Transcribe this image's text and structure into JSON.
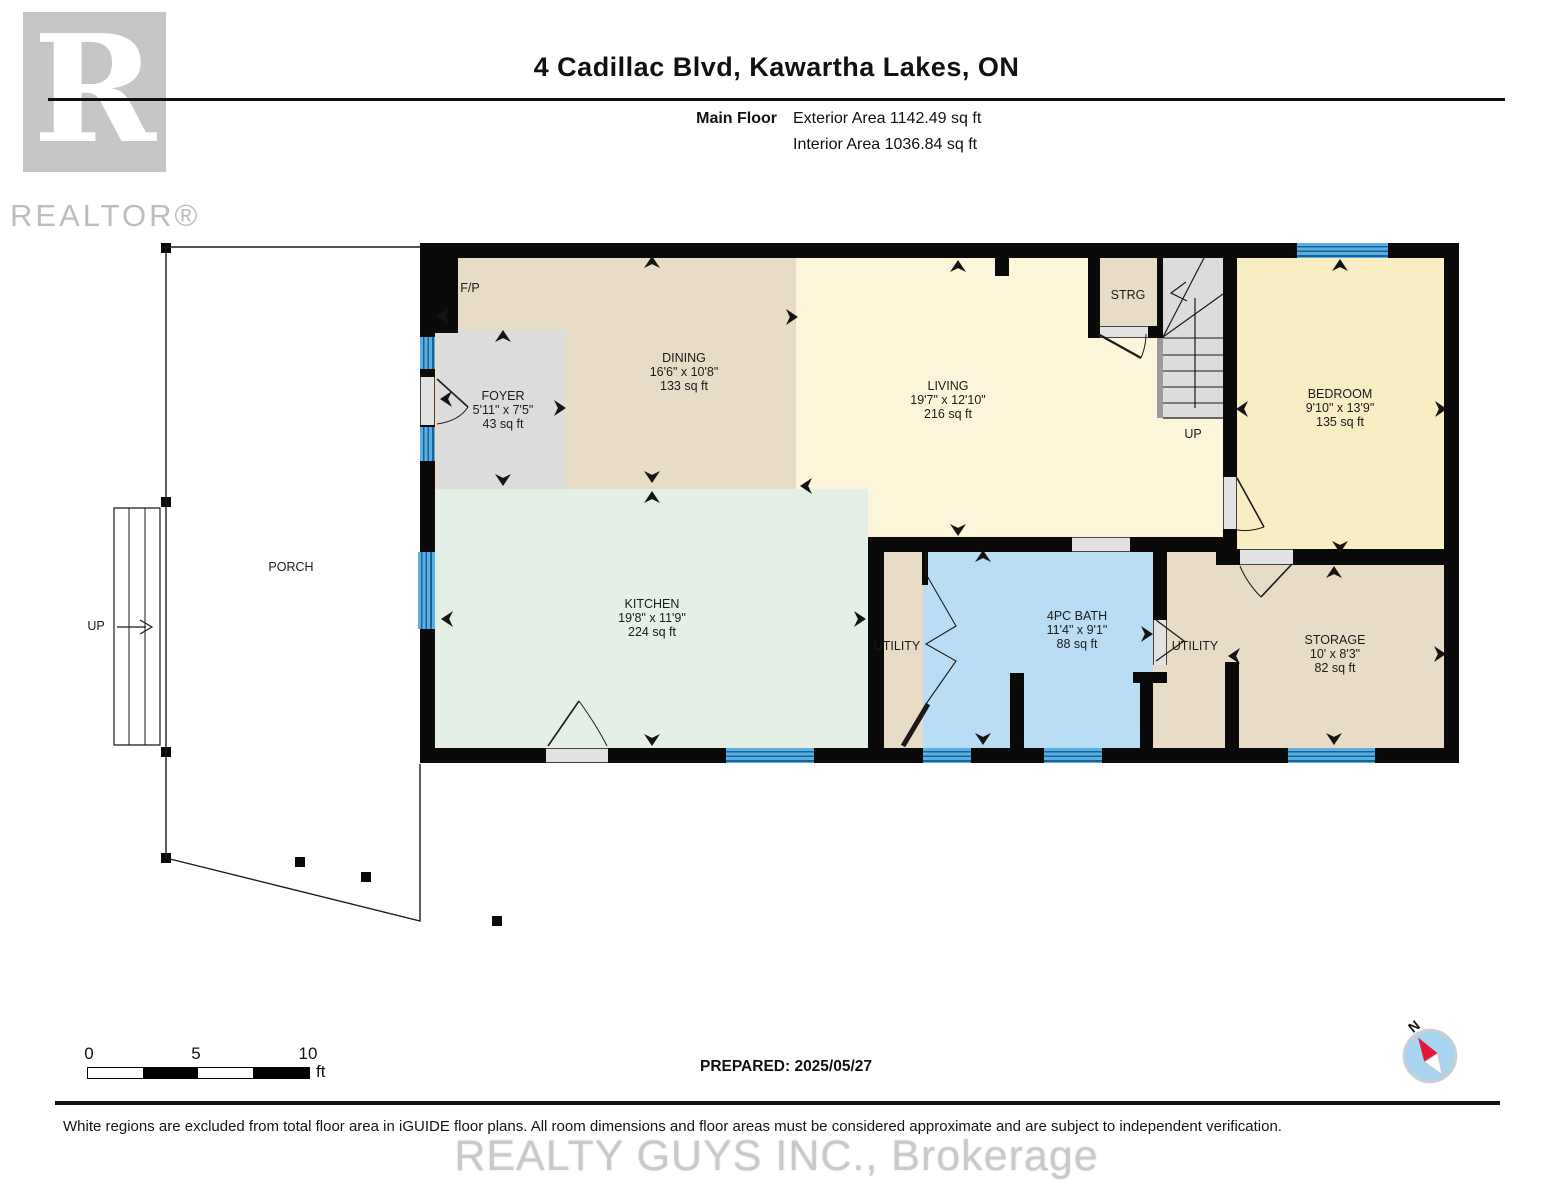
{
  "header": {
    "title": "4 Cadillac Blvd, Kawartha Lakes, ON",
    "floor_label": "Main Floor",
    "exterior_area": "Exterior Area 1142.49 sq ft",
    "interior_area": "Interior Area 1036.84 sq ft",
    "logo_letter": "R",
    "logo_text": "REALTOR®"
  },
  "footer": {
    "scale": {
      "ticks": [
        "0",
        "5",
        "10"
      ],
      "unit": "ft"
    },
    "prepared": "PREPARED: 2025/05/27",
    "disclaimer": "White regions are excluded from total floor area in iGUIDE floor plans. All room dimensions and floor areas must be considered approximate and are subject to independent verification.",
    "watermark": "REALTY GUYS INC., Brokerage",
    "compass_label": "N"
  },
  "colors": {
    "wall": "#0a0a0a",
    "dining_tan": "#e9dcc6",
    "living_cream": "#fcf5da",
    "bedroom_yellow": "#f9edc4",
    "foyer_gray": "#dcdcdc",
    "kitchen_mint": "#e4efe6",
    "bath_blue": "#b8ddf5",
    "stairs_gray": "#dcdcdc",
    "window_blue": "#4aa4da",
    "compass_red": "#e31837"
  },
  "plan": {
    "fills": [
      {
        "name": "dining-floor",
        "x": 435,
        "y": 256,
        "w": 363,
        "h": 233,
        "c": "#e9dcc6"
      },
      {
        "name": "living-floor",
        "x": 796,
        "y": 256,
        "w": 434,
        "h": 281,
        "c": "#fcf5da"
      },
      {
        "name": "foyer-floor",
        "x": 438,
        "y": 330,
        "w": 128,
        "h": 159,
        "c": "#dcdcdc"
      },
      {
        "name": "kitchen-floor",
        "x": 435,
        "y": 489,
        "w": 433,
        "h": 259,
        "c": "#e4efe6"
      },
      {
        "name": "strg-floor",
        "x": 1100,
        "y": 256,
        "w": 58,
        "h": 76,
        "c": "#e9dcc6"
      },
      {
        "name": "stairs-floor",
        "x": 1163,
        "y": 256,
        "w": 60,
        "h": 162,
        "c": "#dcdcdc"
      },
      {
        "name": "stairs-edge",
        "x": 1157,
        "y": 337,
        "w": 6,
        "h": 81,
        "c": "#9a9a9a"
      },
      {
        "name": "utility1-floor",
        "x": 884,
        "y": 552,
        "w": 39,
        "h": 196,
        "c": "#e9dcc6"
      },
      {
        "name": "bath-floor",
        "x": 923,
        "y": 552,
        "w": 230,
        "h": 196,
        "c": "#b8ddf5"
      },
      {
        "name": "utility2-floor",
        "x": 1167,
        "y": 552,
        "w": 58,
        "h": 196,
        "c": "#e9dcc6"
      },
      {
        "name": "storage-floor",
        "x": 1225,
        "y": 565,
        "w": 219,
        "h": 183,
        "c": "#e9dcc6"
      },
      {
        "name": "utility2-patch",
        "x": 1153,
        "y": 665,
        "w": 14,
        "h": 83,
        "c": "#e9dcc6"
      },
      {
        "name": "bedroom-floor",
        "x": 1237,
        "y": 256,
        "w": 207,
        "h": 293,
        "c": "#f9edc4"
      }
    ],
    "walls": [
      {
        "name": "wall-top",
        "x": 420,
        "y": 243,
        "w": 1039,
        "h": 15
      },
      {
        "name": "wall-bottom",
        "x": 420,
        "y": 748,
        "w": 1039,
        "h": 15
      },
      {
        "name": "wall-left",
        "x": 420,
        "y": 243,
        "w": 15,
        "h": 520
      },
      {
        "name": "wall-right",
        "x": 1444,
        "y": 243,
        "w": 15,
        "h": 520
      },
      {
        "name": "fireplace-mass",
        "x": 420,
        "y": 243,
        "w": 38,
        "h": 90
      },
      {
        "name": "wall-living-bath",
        "x": 868,
        "y": 537,
        "w": 362,
        "h": 15
      },
      {
        "name": "wall-kitchen-utility",
        "x": 868,
        "y": 537,
        "w": 16,
        "h": 211
      },
      {
        "name": "wall-bedroom-left",
        "x": 1223,
        "y": 243,
        "w": 14,
        "h": 306
      },
      {
        "name": "wall-bedroom-bottom",
        "x": 1216,
        "y": 549,
        "w": 243,
        "h": 16
      },
      {
        "name": "wall-strg-left",
        "x": 1088,
        "y": 243,
        "w": 12,
        "h": 95
      },
      {
        "name": "wall-strg-bottom",
        "x": 1088,
        "y": 326,
        "w": 75,
        "h": 12
      },
      {
        "name": "wall-strg-stairs",
        "x": 1157,
        "y": 243,
        "w": 6,
        "h": 95
      },
      {
        "name": "wall-top-stub",
        "x": 995,
        "y": 258,
        "w": 14,
        "h": 18
      },
      {
        "name": "wall-bifold-stub",
        "x": 922,
        "y": 552,
        "w": 6,
        "h": 33
      },
      {
        "name": "wall-bath-right-upper",
        "x": 1153,
        "y": 537,
        "w": 14,
        "h": 83
      },
      {
        "name": "wall-bath-jog",
        "x": 1133,
        "y": 672,
        "w": 34,
        "h": 11
      },
      {
        "name": "wall-bath-right-lower",
        "x": 1140,
        "y": 683,
        "w": 13,
        "h": 65
      },
      {
        "name": "wall-bath-stub",
        "x": 1010,
        "y": 673,
        "w": 14,
        "h": 75
      },
      {
        "name": "wall-utility2-storage",
        "x": 1225,
        "y": 662,
        "w": 14,
        "h": 86
      }
    ],
    "windows": [
      {
        "name": "window-foyer-1",
        "x": 420,
        "y": 337,
        "w": 15,
        "h": 32,
        "o": "v"
      },
      {
        "name": "window-foyer-2",
        "x": 420,
        "y": 427,
        "w": 15,
        "h": 34,
        "o": "v"
      },
      {
        "name": "window-kitchen-left",
        "x": 418,
        "y": 552,
        "w": 17,
        "h": 77,
        "o": "v"
      },
      {
        "name": "window-kitchen-bottom",
        "x": 726,
        "y": 748,
        "w": 88,
        "h": 15,
        "o": "h"
      },
      {
        "name": "window-bath-1",
        "x": 923,
        "y": 748,
        "w": 48,
        "h": 15,
        "o": "h"
      },
      {
        "name": "window-bath-2",
        "x": 1044,
        "y": 748,
        "w": 58,
        "h": 15,
        "o": "h"
      },
      {
        "name": "window-storage",
        "x": 1288,
        "y": 748,
        "w": 87,
        "h": 15,
        "o": "h"
      },
      {
        "name": "window-bedroom",
        "x": 1297,
        "y": 243,
        "w": 91,
        "h": 15,
        "o": "h"
      }
    ],
    "openings": [
      {
        "name": "front-door-opening",
        "x": 420,
        "y": 377,
        "w": 15,
        "h": 48,
        "o": "v"
      },
      {
        "name": "kitchen-door-opening",
        "x": 546,
        "y": 748,
        "w": 62,
        "h": 15,
        "o": "h"
      },
      {
        "name": "cased-opening-bath",
        "x": 1072,
        "y": 537,
        "w": 58,
        "h": 15,
        "o": "h"
      },
      {
        "name": "bedroom-door-opening",
        "x": 1223,
        "y": 477,
        "w": 14,
        "h": 52,
        "o": "v"
      },
      {
        "name": "strg-door-opening",
        "x": 1100,
        "y": 326,
        "w": 48,
        "h": 12,
        "o": "h"
      },
      {
        "name": "storage-door-opening",
        "x": 1240,
        "y": 549,
        "w": 53,
        "h": 16,
        "o": "h"
      },
      {
        "name": "utility2-door-opening",
        "x": 1153,
        "y": 620,
        "w": 14,
        "h": 45,
        "o": "v"
      }
    ],
    "posts": [
      {
        "x": 161,
        "y": 243
      },
      {
        "x": 161,
        "y": 497
      },
      {
        "x": 161,
        "y": 747
      },
      {
        "x": 161,
        "y": 853
      },
      {
        "x": 295,
        "y": 857
      },
      {
        "x": 361,
        "y": 872
      },
      {
        "x": 492,
        "y": 916
      }
    ],
    "labels": [
      {
        "name": "label-fireplace",
        "x": 470,
        "y": 288,
        "lines": [
          "F/P"
        ]
      },
      {
        "name": "label-foyer",
        "x": 503,
        "y": 410,
        "lines": [
          "FOYER",
          "5'11\" x 7'5\"",
          "43 sq ft"
        ]
      },
      {
        "name": "label-dining",
        "x": 684,
        "y": 372,
        "lines": [
          "DINING",
          "16'6\" x 10'8\"",
          "133 sq ft"
        ]
      },
      {
        "name": "label-living",
        "x": 948,
        "y": 400,
        "lines": [
          "LIVING",
          "19'7\" x 12'10\"",
          "216 sq ft"
        ]
      },
      {
        "name": "label-strg",
        "x": 1128,
        "y": 295,
        "lines": [
          "STRG"
        ]
      },
      {
        "name": "label-stairs-up",
        "x": 1193,
        "y": 434,
        "lines": [
          "UP"
        ]
      },
      {
        "name": "label-bedroom",
        "x": 1340,
        "y": 408,
        "lines": [
          "BEDROOM",
          "9'10\" x 13'9\"",
          "135 sq ft"
        ]
      },
      {
        "name": "label-porch",
        "x": 291,
        "y": 567,
        "lines": [
          "PORCH"
        ]
      },
      {
        "name": "label-porch-up",
        "x": 96,
        "y": 626,
        "lines": [
          "UP"
        ]
      },
      {
        "name": "label-kitchen",
        "x": 652,
        "y": 618,
        "lines": [
          "KITCHEN",
          "19'8\" x 11'9\"",
          "224 sq ft"
        ]
      },
      {
        "name": "label-utility-left",
        "x": 897,
        "y": 646,
        "lines": [
          "UTILITY"
        ]
      },
      {
        "name": "label-bath",
        "x": 1077,
        "y": 630,
        "lines": [
          "4PC BATH",
          "11'4\" x 9'1\"",
          "88 sq ft"
        ]
      },
      {
        "name": "label-utility-right",
        "x": 1195,
        "y": 646,
        "lines": [
          "UTILITY"
        ]
      },
      {
        "name": "label-storage",
        "x": 1335,
        "y": 654,
        "lines": [
          "STORAGE",
          "10' x 8'3\"",
          "82 sq ft"
        ]
      }
    ],
    "arrows": [
      {
        "x": 652,
        "y": 262,
        "d": "u"
      },
      {
        "x": 443,
        "y": 316,
        "d": "l"
      },
      {
        "x": 503,
        "y": 336,
        "d": "u"
      },
      {
        "x": 560,
        "y": 408,
        "d": "r"
      },
      {
        "x": 446,
        "y": 399,
        "d": "l"
      },
      {
        "x": 503,
        "y": 480,
        "d": "d"
      },
      {
        "x": 652,
        "y": 477,
        "d": "d"
      },
      {
        "x": 652,
        "y": 497,
        "d": "u"
      },
      {
        "x": 792,
        "y": 317,
        "d": "r"
      },
      {
        "x": 806,
        "y": 486,
        "d": "l"
      },
      {
        "x": 958,
        "y": 266,
        "d": "u"
      },
      {
        "x": 958,
        "y": 530,
        "d": "d"
      },
      {
        "x": 447,
        "y": 619,
        "d": "l"
      },
      {
        "x": 860,
        "y": 619,
        "d": "r"
      },
      {
        "x": 652,
        "y": 740,
        "d": "d"
      },
      {
        "x": 983,
        "y": 556,
        "d": "u"
      },
      {
        "x": 983,
        "y": 739,
        "d": "d"
      },
      {
        "x": 1147,
        "y": 634,
        "d": "r"
      },
      {
        "x": 1234,
        "y": 656,
        "d": "l"
      },
      {
        "x": 1440,
        "y": 654,
        "d": "r"
      },
      {
        "x": 1334,
        "y": 572,
        "d": "u"
      },
      {
        "x": 1334,
        "y": 739,
        "d": "d"
      },
      {
        "x": 1340,
        "y": 265,
        "d": "u"
      },
      {
        "x": 1441,
        "y": 409,
        "d": "r"
      },
      {
        "x": 1242,
        "y": 409,
        "d": "l"
      },
      {
        "x": 1340,
        "y": 547,
        "d": "d"
      }
    ],
    "svg": [
      {
        "d": "M166 247 H420",
        "w": 1.4
      },
      {
        "d": "M166 247 V858 L420 921 V764",
        "w": 1.4
      },
      {
        "d": "M114 508 H160 V745 H114 Z",
        "w": 1.2,
        "f": "#ffffff"
      },
      {
        "d": "M129 508 V745",
        "w": 1
      },
      {
        "d": "M145 508 V745",
        "w": 1
      },
      {
        "d": "M117 627 H146",
        "w": 1.2
      },
      {
        "d": "M140 620 L152 627 L140 634",
        "w": 1.2
      },
      {
        "d": "M1163 338 H1223",
        "w": 1
      },
      {
        "d": "M1163 355 H1223",
        "w": 1
      },
      {
        "d": "M1163 371 H1223",
        "w": 1
      },
      {
        "d": "M1163 387 H1223",
        "w": 1
      },
      {
        "d": "M1163 403 H1223",
        "w": 1
      },
      {
        "d": "M1163 418 H1223",
        "w": 1.2
      },
      {
        "d": "M1163 337 L1205 256",
        "w": 1.2
      },
      {
        "d": "M1163 337 L1223 294",
        "w": 1.2
      },
      {
        "d": "M1195 408 V298",
        "w": 1.2
      },
      {
        "d": "M1186 282 L1171 293 L1187 301",
        "w": 1.2
      },
      {
        "d": "M437 379 L468 407",
        "w": 1.6
      },
      {
        "d": "M468 407 Q459 421 437 424",
        "w": 1
      },
      {
        "d": "M548 746 L579 701",
        "w": 1.6
      },
      {
        "d": "M579 701 Q597 726 607 746",
        "w": 1
      },
      {
        "d": "M1098 334 L1141 358",
        "w": 2.2
      },
      {
        "d": "M1141 358 Q1146 346 1146 334",
        "w": 1
      },
      {
        "d": "M1237 478 L1264 527",
        "w": 1.6
      },
      {
        "d": "M1264 527 Q1250 532 1237 530",
        "w": 1
      },
      {
        "d": "M1292 564 L1261 597",
        "w": 1.6
      },
      {
        "d": "M1261 597 Q1247 583 1240 566",
        "w": 1
      },
      {
        "d": "M1156 620 L1184 641 L1156 661",
        "w": 1.3
      },
      {
        "d": "M926 574 L956 626 L926 644 L956 661 L926 704",
        "w": 1.1
      },
      {
        "d": "M926 552 V574",
        "w": 1.1
      },
      {
        "d": "M928 704 L903 746",
        "w": 5
      }
    ]
  }
}
